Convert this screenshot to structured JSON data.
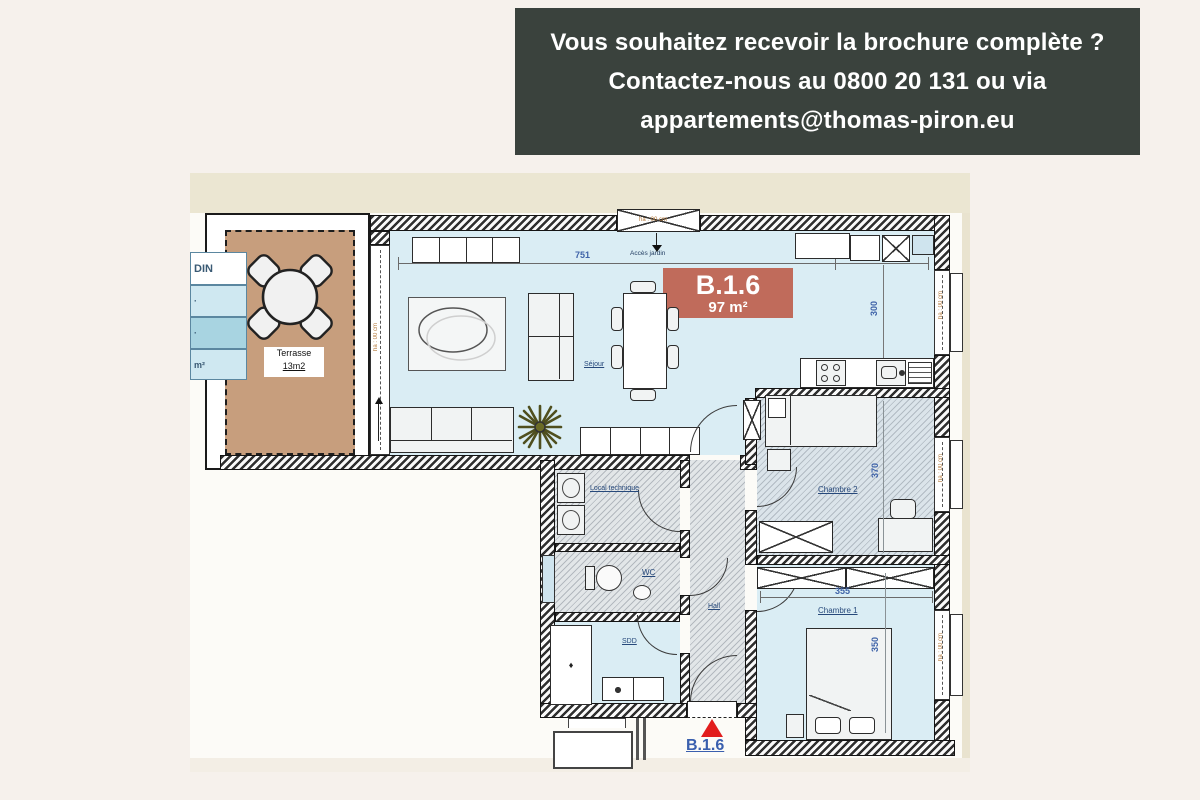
{
  "banner": {
    "line1": "Vous souhaitez recevoir la brochure complète ?",
    "line2": "Contactez-nous au 0800 20 131 ou via",
    "line3": "appartements@thomas-piron.eu"
  },
  "unit": {
    "code": "B.1.6",
    "area": "97 m²",
    "entrance_code": "B.1.6"
  },
  "rooms": {
    "sejour": "Séjour",
    "chambre1": "Chambre 1",
    "chambre2": "Chambre 2",
    "local_technique": "Local technique",
    "wc": "WC",
    "sdd": "SDD",
    "hall": "Hall",
    "terrasse_name": "Terrasse",
    "terrasse_area": "13m2"
  },
  "dimensions": {
    "sejour_width": "751",
    "kitchen_width": "336",
    "sejour_depth": "420",
    "kitchen_depth": "300",
    "chambre2_depth": "370",
    "chambre1_width": "355",
    "chambre1_depth": "350"
  },
  "annotations": {
    "acces_jardin": "Accès jardin",
    "window_height": "ha : 00 cm",
    "shower_mark": "♦"
  },
  "legend": {
    "header": "DIN",
    "row1": "·",
    "row2": "·",
    "row3": "m²"
  },
  "colors": {
    "page_bg": "#f6f1ec",
    "banner_bg": "#3a423d",
    "unit_tag_bg": "#c06b5b",
    "terrace": "#c79e7d",
    "floor": "#daedf4",
    "accent_red": "#e21d1d",
    "legend_blue_light": "#cfe8f1",
    "legend_blue_mid": "#a8d4e1"
  }
}
